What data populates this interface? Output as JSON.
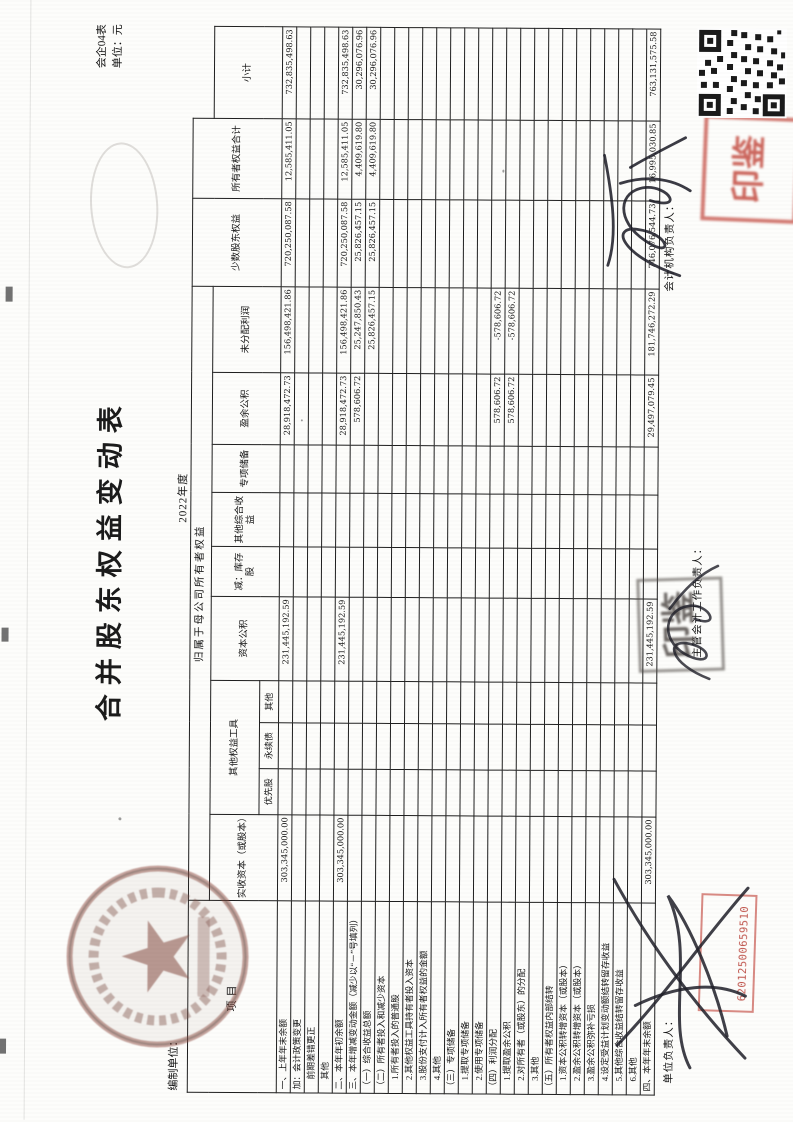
{
  "page": {
    "title": "合并股东权益变动表",
    "form_no": "会企04表",
    "unit_label": "单位：元",
    "prepared_by_label": "编制单位：",
    "period": "2022年度"
  },
  "table": {
    "stub_header": "项目",
    "group_header": "归属于母公司所有者权益",
    "col_headers": [
      "实收资本（或股本）",
      "其他权益工具",
      "资本公积",
      "减：库存股",
      "其他综合收益",
      "专项储备",
      "盈余公积",
      "未分配利润",
      "小计"
    ],
    "other_equity_sub": [
      "优先股",
      "永续债",
      "其他"
    ],
    "col_minority": "少数股东权益",
    "col_total": "所有者权益合计",
    "rows": [
      {
        "label": "一、上年年末余额",
        "indent": 0,
        "values": [
          "303,345,000.00",
          "",
          "",
          "",
          "231,445,192.59",
          "",
          "",
          "",
          "28,918,472.73",
          "156,498,421.86",
          "720,250,087.58",
          "12,585,411.05",
          "732,835,498.63"
        ]
      },
      {
        "label": "加：会计政策变更",
        "indent": 0,
        "values": [
          "",
          "",
          "",
          "",
          "",
          "",
          "",
          "",
          "",
          "",
          "",
          "",
          ""
        ]
      },
      {
        "label": "前期差错更正",
        "indent": 1,
        "values": [
          "",
          "",
          "",
          "",
          "",
          "",
          "",
          "",
          "",
          "",
          "",
          "",
          ""
        ]
      },
      {
        "label": "其他",
        "indent": 1,
        "values": [
          "",
          "",
          "",
          "",
          "",
          "",
          "",
          "",
          "",
          "",
          "",
          "",
          ""
        ]
      },
      {
        "label": "二、本年年初余额",
        "indent": 0,
        "values": [
          "303,345,000.00",
          "",
          "",
          "",
          "231,445,192.59",
          "",
          "",
          "",
          "28,918,472.73",
          "156,498,421.86",
          "720,250,087.58",
          "12,585,411.05",
          "732,835,498.63"
        ]
      },
      {
        "label": "三、本年增减变动金额（减少以“－”号填列）",
        "indent": 0,
        "values": [
          "",
          "",
          "",
          "",
          "",
          "",
          "",
          "",
          "578,606.72",
          "25,247,850.43",
          "25,826,457.15",
          "4,409,619.80",
          "30,296,076.96"
        ]
      },
      {
        "label": "（一）综合收益总额",
        "indent": 0,
        "values": [
          "",
          "",
          "",
          "",
          "",
          "",
          "",
          "",
          "",
          "25,826,457.15",
          "25,826,457.15",
          "4,409,619.80",
          "30,296,076.96"
        ]
      },
      {
        "label": "（二）所有者投入和减少资本",
        "indent": 0,
        "values": [
          "",
          "",
          "",
          "",
          "",
          "",
          "",
          "",
          "",
          "",
          "",
          "",
          ""
        ]
      },
      {
        "label": "1.所有者投入的普通股",
        "indent": 1,
        "values": [
          "",
          "",
          "",
          "",
          "",
          "",
          "",
          "",
          "",
          "",
          "",
          "",
          ""
        ]
      },
      {
        "label": "2.其他权益工具持有者投入资本",
        "indent": 1,
        "values": [
          "",
          "",
          "",
          "",
          "",
          "",
          "",
          "",
          "",
          "",
          "",
          "",
          ""
        ]
      },
      {
        "label": "3.股份支付计入所有者权益的金额",
        "indent": 1,
        "values": [
          "",
          "",
          "",
          "",
          "",
          "",
          "",
          "",
          "",
          "",
          "",
          "",
          ""
        ]
      },
      {
        "label": "4.其他",
        "indent": 1,
        "values": [
          "",
          "",
          "",
          "",
          "",
          "",
          "",
          "",
          "",
          "",
          "",
          "",
          ""
        ]
      },
      {
        "label": "（三）专项储备",
        "indent": 0,
        "values": [
          "",
          "",
          "",
          "",
          "",
          "",
          "",
          "",
          "",
          "",
          "",
          "",
          ""
        ]
      },
      {
        "label": "1.提取专项储备",
        "indent": 1,
        "values": [
          "",
          "",
          "",
          "",
          "",
          "",
          "",
          "",
          "",
          "",
          "",
          "",
          ""
        ]
      },
      {
        "label": "2.使用专项储备",
        "indent": 1,
        "values": [
          "",
          "",
          "",
          "",
          "",
          "",
          "",
          "",
          "",
          "",
          "",
          "",
          ""
        ]
      },
      {
        "label": "（四）利润分配",
        "indent": 0,
        "values": [
          "",
          "",
          "",
          "",
          "",
          "",
          "",
          "",
          "578,606.72",
          "-578,606.72",
          "",
          "",
          ""
        ]
      },
      {
        "label": "1.提取盈余公积",
        "indent": 1,
        "values": [
          "",
          "",
          "",
          "",
          "",
          "",
          "",
          "",
          "578,606.72",
          "-578,606.72",
          "",
          "",
          ""
        ]
      },
      {
        "label": "2.对所有者（或股东）的分配",
        "indent": 1,
        "values": [
          "",
          "",
          "",
          "",
          "",
          "",
          "",
          "",
          "",
          "",
          "",
          "",
          ""
        ]
      },
      {
        "label": "3.其他",
        "indent": 1,
        "values": [
          "",
          "",
          "",
          "",
          "",
          "",
          "",
          "",
          "",
          "",
          "",
          "",
          ""
        ]
      },
      {
        "label": "（五）所有者权益内部结转",
        "indent": 0,
        "values": [
          "",
          "",
          "",
          "",
          "",
          "",
          "",
          "",
          "",
          "",
          "",
          "",
          ""
        ]
      },
      {
        "label": "1.资本公积转增资本（或股本）",
        "indent": 1,
        "values": [
          "",
          "",
          "",
          "",
          "",
          "",
          "",
          "",
          "",
          "",
          "",
          "",
          ""
        ]
      },
      {
        "label": "2.盈余公积转增资本（或股本）",
        "indent": 1,
        "values": [
          "",
          "",
          "",
          "",
          "",
          "",
          "",
          "",
          "",
          "",
          "",
          "",
          ""
        ]
      },
      {
        "label": "3.盈余公积弥补亏损",
        "indent": 1,
        "values": [
          "",
          "",
          "",
          "",
          "",
          "",
          "",
          "",
          "",
          "",
          "",
          "",
          ""
        ]
      },
      {
        "label": "4.设定受益计划变动额结转留存收益",
        "indent": 1,
        "values": [
          "",
          "",
          "",
          "",
          "",
          "",
          "",
          "",
          "",
          "",
          "",
          "",
          ""
        ]
      },
      {
        "label": "5.其他综合收益结转留存收益",
        "indent": 1,
        "values": [
          "",
          "",
          "",
          "",
          "",
          "",
          "",
          "",
          "",
          "",
          "",
          "",
          ""
        ]
      },
      {
        "label": "6.其他",
        "indent": 1,
        "values": [
          "",
          "",
          "",
          "",
          "",
          "",
          "",
          "",
          "",
          "",
          "",
          "",
          ""
        ]
      },
      {
        "label": "四、本年年末余额",
        "indent": 0,
        "values": [
          "303,345,000.00",
          "",
          "",
          "",
          "231,445,192.59",
          "",
          "",
          "",
          "29,497,079.45",
          "181,746,272.29",
          "746,076,544.73",
          "16,995,030.85",
          "763,131,575.58"
        ]
      }
    ]
  },
  "footer": {
    "unit_head_label": "单位负责人：",
    "chief_accountant_label": "主管会计工作负责人：",
    "accounting_head_label": "会计机构负责人："
  },
  "stamps": {
    "serial_number": "62012500659510",
    "red_seal_chars": "印鉴",
    "grey_seal_chars": "印鉴"
  }
}
